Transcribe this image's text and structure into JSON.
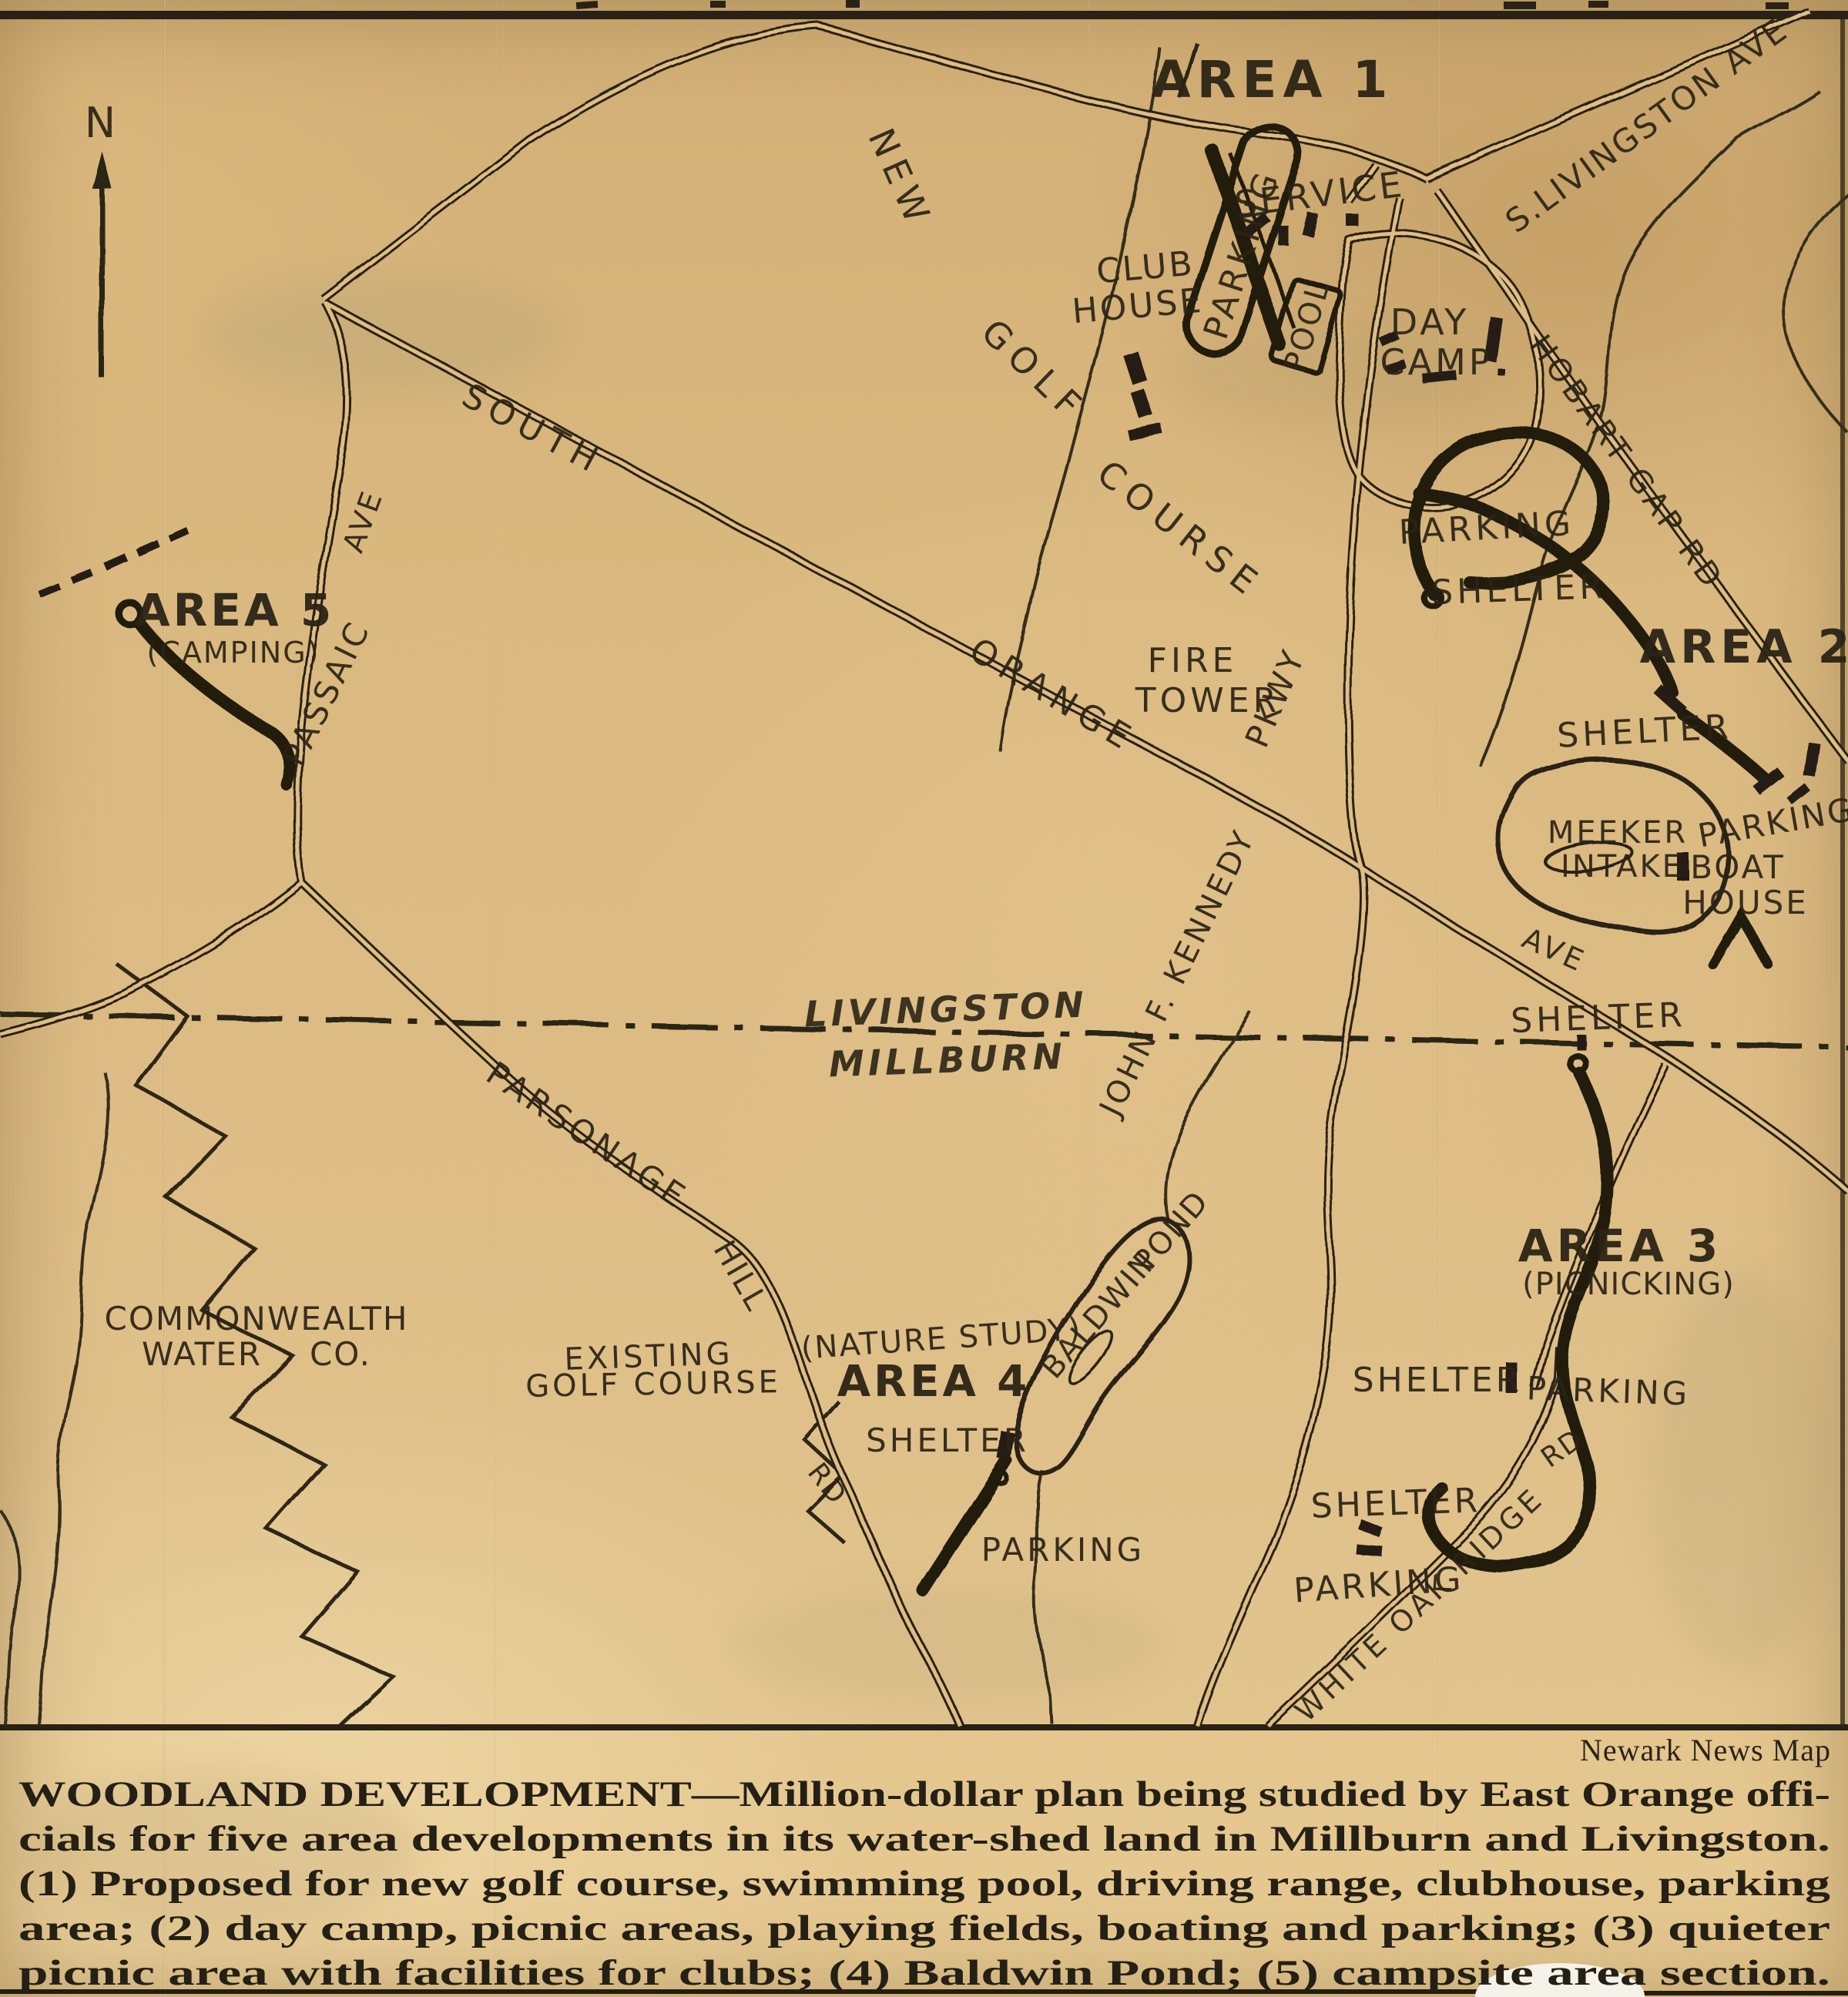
{
  "credit": "Newark News Map",
  "caption": {
    "lines": [
      "WOODLAND DEVELOPMENT—Million-dollar plan being studied by East Orange offi-",
      "cials for five area developments in its water-shed land in Millburn and Livingston.",
      "(1) Proposed for new golf course, swimming pool, driving range, clubhouse, parking",
      "area; (2) day camp, picnic areas, playing fields, boating and parking; (3) quieter",
      "picnic area with facilities for clubs; (4) Baldwin Pond; (5) campsite area section."
    ]
  },
  "labels": {
    "compass_n": "N",
    "area1": "AREA 1",
    "service": "SERVICE",
    "club": "CLUB",
    "club_house": "HOUSE",
    "parking_area1": "PARKING",
    "pool": "POOL",
    "day": "DAY",
    "camp": "CAMP",
    "s_livingston_ave": "S.LIVINGSTON AVE",
    "hobart_gap_rd": "HOBART GAP RD",
    "new_lbl": "NEW",
    "golf_lbl": "GOLF",
    "course_lbl": "COURSE",
    "south_lbl": "SOUTH",
    "orange_lbl": "ORANGE",
    "fire_lbl": "FIRE",
    "tower_lbl": "TOWER",
    "pkwy_lbl": "PKWY",
    "jfk_lbl": "JOHN F. KENNEDY",
    "livingston_lbl": "LIVINGSTON",
    "millburn_lbl": "MILLBURN",
    "passaic_lbl": "PASSAIC",
    "passaic_ave_lbl": "AVE",
    "area5": "AREA 5",
    "camping": "(CAMPING)",
    "parking_area2": "PARKING",
    "shelter_area2": "SHELTER",
    "area2": "AREA 2",
    "shelter_area2b": "SHELTER",
    "meeker": "MEEKER",
    "intake": "INTAKE",
    "parking_boat": "PARKING",
    "boat": "BOAT",
    "boat_house": "HOUSE",
    "orange_ave_lbl": "AVE",
    "shelter_boundary": "SHELTER",
    "area3": "AREA 3",
    "picnicking": "(PICNICKING)",
    "shelter_area3a": "SHELTER",
    "parking_area3a": "PARKING",
    "rd_white_oak": "RD",
    "shelter_area3b": "SHELTER",
    "parking_area3b": "PARKING",
    "white_oak_ridge": "WHITE OAK RIDGE",
    "nature_study": "(NATURE STUDY)",
    "area4": "AREA 4",
    "shelter_area4": "SHELTER",
    "parking_area4": "PARKING",
    "baldwin": "BALDWIN",
    "pond": "POND",
    "parsonage": "PARSONAGE",
    "hill": "HILL",
    "rd_parsonage": "RD",
    "commonwealth": "COMMONWEALTH",
    "water": "WATER",
    "co": "CO.",
    "existing": "EXISTING",
    "existing_golf": "GOLF COURSE"
  }
}
